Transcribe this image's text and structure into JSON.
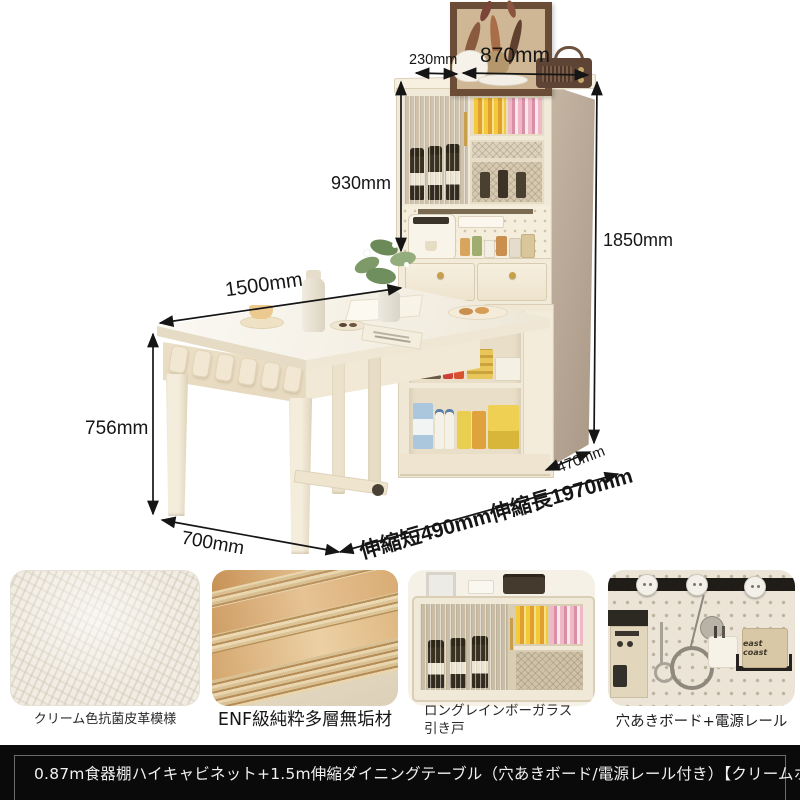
{
  "product": {
    "title": "0.87m食器棚ハイキャビネット+1.5m伸縮ダイニングテーブル（穴あきボード/電源レール付き）【クリームホワイト】"
  },
  "dimensions": {
    "top_depth": "230mm",
    "cabinet_width": "870mm",
    "hutch_height": "930mm",
    "total_height": "1850mm",
    "table_length": "1500mm",
    "table_height": "756mm",
    "table_width": "700mm",
    "cabinet_depth": "470mm",
    "extension_range": "伸縮短490mm伸縮長1970mm"
  },
  "features": [
    {
      "caption": "クリーム色抗菌皮革模様"
    },
    {
      "caption": "ENF級純粋多層無垢材"
    },
    {
      "caption": "ロングレインボーガラス引き戸"
    },
    {
      "caption": "穴あきボード+電源レール",
      "bag_label": "east coast"
    }
  ],
  "colors": {
    "cream": "#f2ead9",
    "cream_dark": "#dccfb8",
    "side_tan": "#b7a593",
    "annotation": "#151515",
    "gold": "#c79f4b",
    "title_bg": "#0a0a0a",
    "title_text": "#f0f0f0"
  }
}
